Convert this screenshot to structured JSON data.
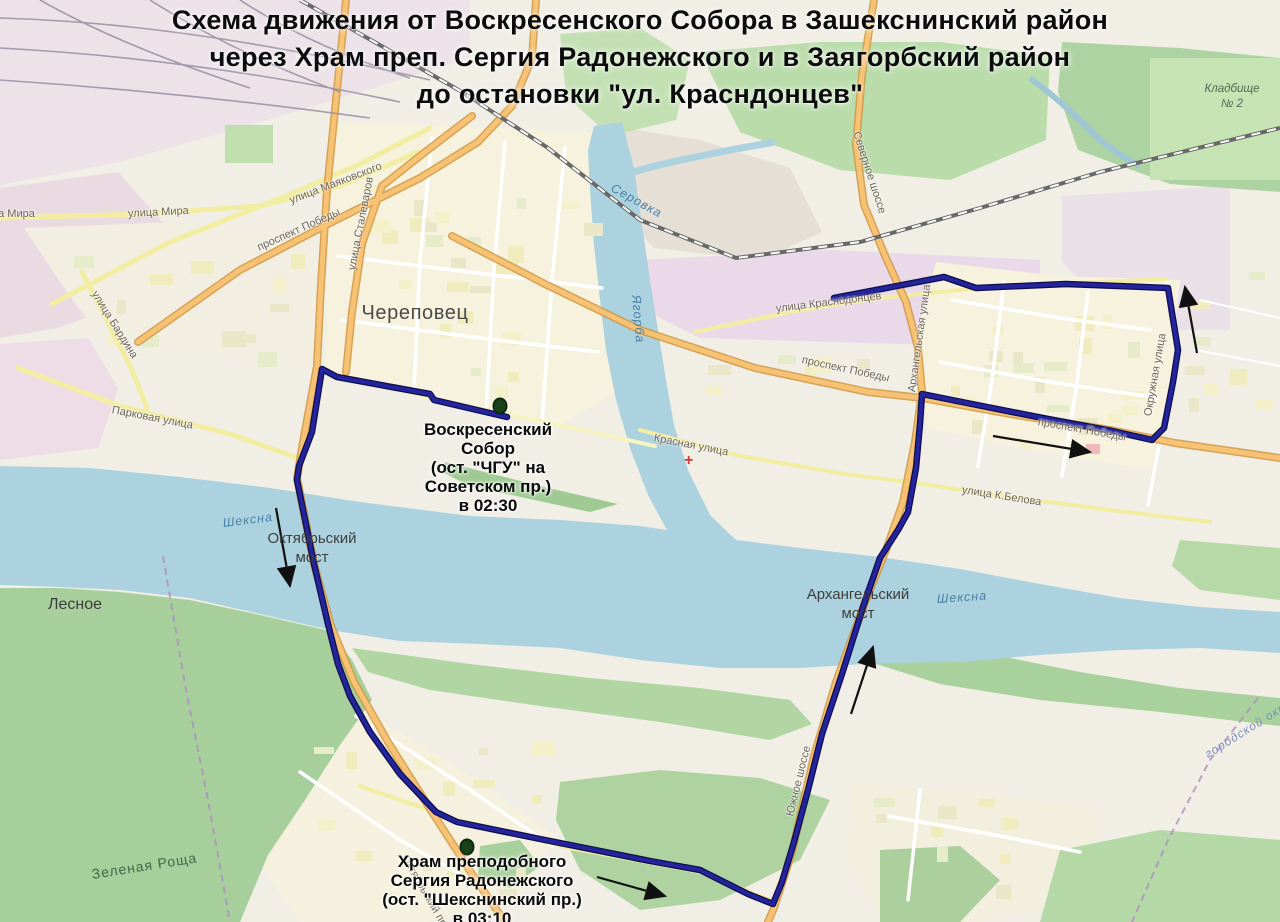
{
  "title": {
    "lines": [
      "Схема движения от Воскресенского Собора в Зашекснинский район",
      "через Храм преп. Сергия Радонежского и в Заягорбский район",
      "до остановки \"ул. Красндонцев\""
    ]
  },
  "route": {
    "color": "#24249c",
    "casing_color": "#0d0d4e",
    "points": [
      [
        507,
        417
      ],
      [
        434,
        400
      ],
      [
        430,
        394
      ],
      [
        337,
        377
      ],
      [
        322,
        369
      ],
      [
        312,
        432
      ],
      [
        299,
        466
      ],
      [
        297,
        480
      ],
      [
        314,
        564
      ],
      [
        328,
        624
      ],
      [
        338,
        664
      ],
      [
        350,
        696
      ],
      [
        370,
        732
      ],
      [
        400,
        774
      ],
      [
        436,
        812
      ],
      [
        457,
        822
      ],
      [
        545,
        840
      ],
      [
        650,
        861
      ],
      [
        700,
        870
      ],
      [
        748,
        894
      ],
      [
        773,
        904
      ],
      [
        782,
        882
      ],
      [
        794,
        842
      ],
      [
        808,
        790
      ],
      [
        822,
        734
      ],
      [
        842,
        674
      ],
      [
        864,
        604
      ],
      [
        880,
        558
      ],
      [
        898,
        530
      ],
      [
        908,
        512
      ],
      [
        916,
        468
      ],
      [
        920,
        424
      ],
      [
        922,
        394
      ],
      [
        972,
        404
      ],
      [
        1048,
        419
      ],
      [
        1112,
        431
      ],
      [
        1152,
        440
      ],
      [
        1164,
        428
      ],
      [
        1173,
        382
      ],
      [
        1178,
        350
      ],
      [
        1168,
        288
      ],
      [
        1066,
        284
      ],
      [
        976,
        288
      ],
      [
        944,
        277
      ],
      [
        834,
        298
      ]
    ]
  },
  "arrows": {
    "color": "#111111",
    "items": [
      {
        "name": "arrow-oktyabrsky-south",
        "x1": 276,
        "y1": 508,
        "x2": 290,
        "y2": 586
      },
      {
        "name": "arrow-sheksninsky-east",
        "x1": 597,
        "y1": 877,
        "x2": 665,
        "y2": 896
      },
      {
        "name": "arrow-arkhangelsky-north",
        "x1": 851,
        "y1": 714,
        "x2": 873,
        "y2": 647
      },
      {
        "name": "arrow-pobedy-east",
        "x1": 993,
        "y1": 436,
        "x2": 1090,
        "y2": 452
      },
      {
        "name": "arrow-krasnodontsev-north",
        "x1": 1197,
        "y1": 353,
        "x2": 1185,
        "y2": 287
      }
    ]
  },
  "stops": {
    "marker_color": "#17421a",
    "items": [
      {
        "name": "stop-voskresensky-sobor",
        "dot": {
          "x": 500,
          "y": 406
        },
        "label": "Воскресенский\nСобор\n(ост. \"ЧГУ\" на\nСоветском пр.)\nв 02:30",
        "label_pos": {
          "x": 488,
          "y": 420
        }
      },
      {
        "name": "stop-khram-sergiya-radonezhskogo",
        "dot": {
          "x": 467,
          "y": 847
        },
        "label": "Храм преподобного\nСергия Радонежского\n(ост. \"Шекснинский пр.)\nв 03:10",
        "label_pos": {
          "x": 482,
          "y": 852
        }
      }
    ]
  },
  "map_labels": [
    {
      "name": "city-label",
      "text": "Череповец",
      "x": 415,
      "y": 302,
      "cls": "place-lg",
      "ctr": 1
    },
    {
      "name": "lesnoye-label",
      "text": "Лесное",
      "x": 75,
      "y": 596,
      "cls": "place",
      "ctr": 1
    },
    {
      "name": "zelyonaya-roshcha-label",
      "text": "Зеленая Роща",
      "x": 145,
      "y": 866,
      "rot": -9,
      "cls": "wood",
      "ctr": 1
    },
    {
      "name": "oktyabrsky-most-label",
      "text": "Октябрьский\nмост",
      "x": 312,
      "y": 530,
      "cls": "bridge",
      "ctr": 1
    },
    {
      "name": "arkhangelsky-most-label",
      "text": "Архангельский\nмост",
      "x": 858,
      "y": 586,
      "cls": "bridge",
      "ctr": 1
    },
    {
      "name": "kladbishche-2-label",
      "text": "Кладбище\n№ 2",
      "x": 1232,
      "y": 82,
      "cls": "cem",
      "ctr": 1
    },
    {
      "name": "sheksna-label-west",
      "text": "Шексна",
      "x": 248,
      "y": 516,
      "rot": -7,
      "cls": "river",
      "ctr": 1
    },
    {
      "name": "sheksna-label-east",
      "text": "Шексна",
      "x": 962,
      "y": 592,
      "rot": -4,
      "cls": "river",
      "ctr": 1
    },
    {
      "name": "yagorba-label",
      "text": "Ягорба",
      "x": 636,
      "y": 288,
      "rot": 85,
      "cls": "river"
    },
    {
      "name": "serovka-label",
      "text": "Серовка",
      "x": 612,
      "y": 180,
      "rot": 29,
      "cls": "river"
    },
    {
      "name": "ulitsa-mira-label-1",
      "text": "улица Мира",
      "x": -26,
      "y": 208,
      "cls": "road"
    },
    {
      "name": "ulitsa-mira-label-2",
      "text": "улица Мира",
      "x": 128,
      "y": 208,
      "rot": -3,
      "cls": "road"
    },
    {
      "name": "prospekt-pobedy-label-west",
      "text": "проспект Победы",
      "x": 258,
      "y": 242,
      "rot": -24,
      "cls": "road"
    },
    {
      "name": "ulitsa-mayakovskogo-label",
      "text": "улица Маяковского",
      "x": 290,
      "y": 195,
      "rot": -21,
      "cls": "road"
    },
    {
      "name": "ulitsa-stalevarov-label",
      "text": "улица Сталеваров",
      "x": 352,
      "y": 264,
      "rot": -79,
      "cls": "road"
    },
    {
      "name": "ulitsa-bardina-label",
      "text": "улица Бардина",
      "x": 94,
      "y": 286,
      "rot": 58,
      "cls": "road"
    },
    {
      "name": "parkovaya-ulitsa-label",
      "text": "Парковая улица",
      "x": 112,
      "y": 404,
      "rot": 11,
      "cls": "road"
    },
    {
      "name": "prospekt-pobedy-label-center",
      "text": "проспект Победы",
      "x": 802,
      "y": 354,
      "rot": 12,
      "cls": "road"
    },
    {
      "name": "prospekt-pobedy-label-east",
      "text": "проспект Победы",
      "x": 1038,
      "y": 416,
      "rot": 10,
      "cls": "road"
    },
    {
      "name": "ulitsa-krasnodontsev-label",
      "text": "улица Краснодонцев",
      "x": 776,
      "y": 303,
      "rot": -7,
      "cls": "road"
    },
    {
      "name": "arkhangelskaya-ulitsa-label",
      "text": "Архангельская улица",
      "x": 912,
      "y": 386,
      "rot": -82,
      "cls": "road"
    },
    {
      "name": "severnoye-shosse-label",
      "text": "Северное шоссе",
      "x": 856,
      "y": 126,
      "rot": 72,
      "cls": "road"
    },
    {
      "name": "yuzhnoye-shosse-label",
      "text": "Южное шоссе",
      "x": 790,
      "y": 810,
      "rot": -76,
      "cls": "road"
    },
    {
      "name": "ulitsa-k-belova-label",
      "text": "улица К.Белова",
      "x": 962,
      "y": 484,
      "rot": 9,
      "cls": "road"
    },
    {
      "name": "krasnaya-ulitsa-label",
      "text": "Красная улица",
      "x": 654,
      "y": 432,
      "rot": 11,
      "cls": "road"
    },
    {
      "name": "oktyabrsky-prospekt-label",
      "text": "Октябрьский проспект",
      "x": 404,
      "y": 850,
      "rot": 60,
      "cls": "road"
    },
    {
      "name": "okruzhnaya-ulitsa-label",
      "text": "Окружная улица",
      "x": 1148,
      "y": 410,
      "rot": -80,
      "cls": "road"
    },
    {
      "name": "gorodskoy-okrug-label",
      "text": "городской округ",
      "x": 1206,
      "y": 748,
      "rot": -32,
      "cls": "boundary"
    },
    {
      "name": "hospital-marker",
      "text": "+",
      "x": 684,
      "y": 452,
      "cls": "hospital"
    }
  ]
}
